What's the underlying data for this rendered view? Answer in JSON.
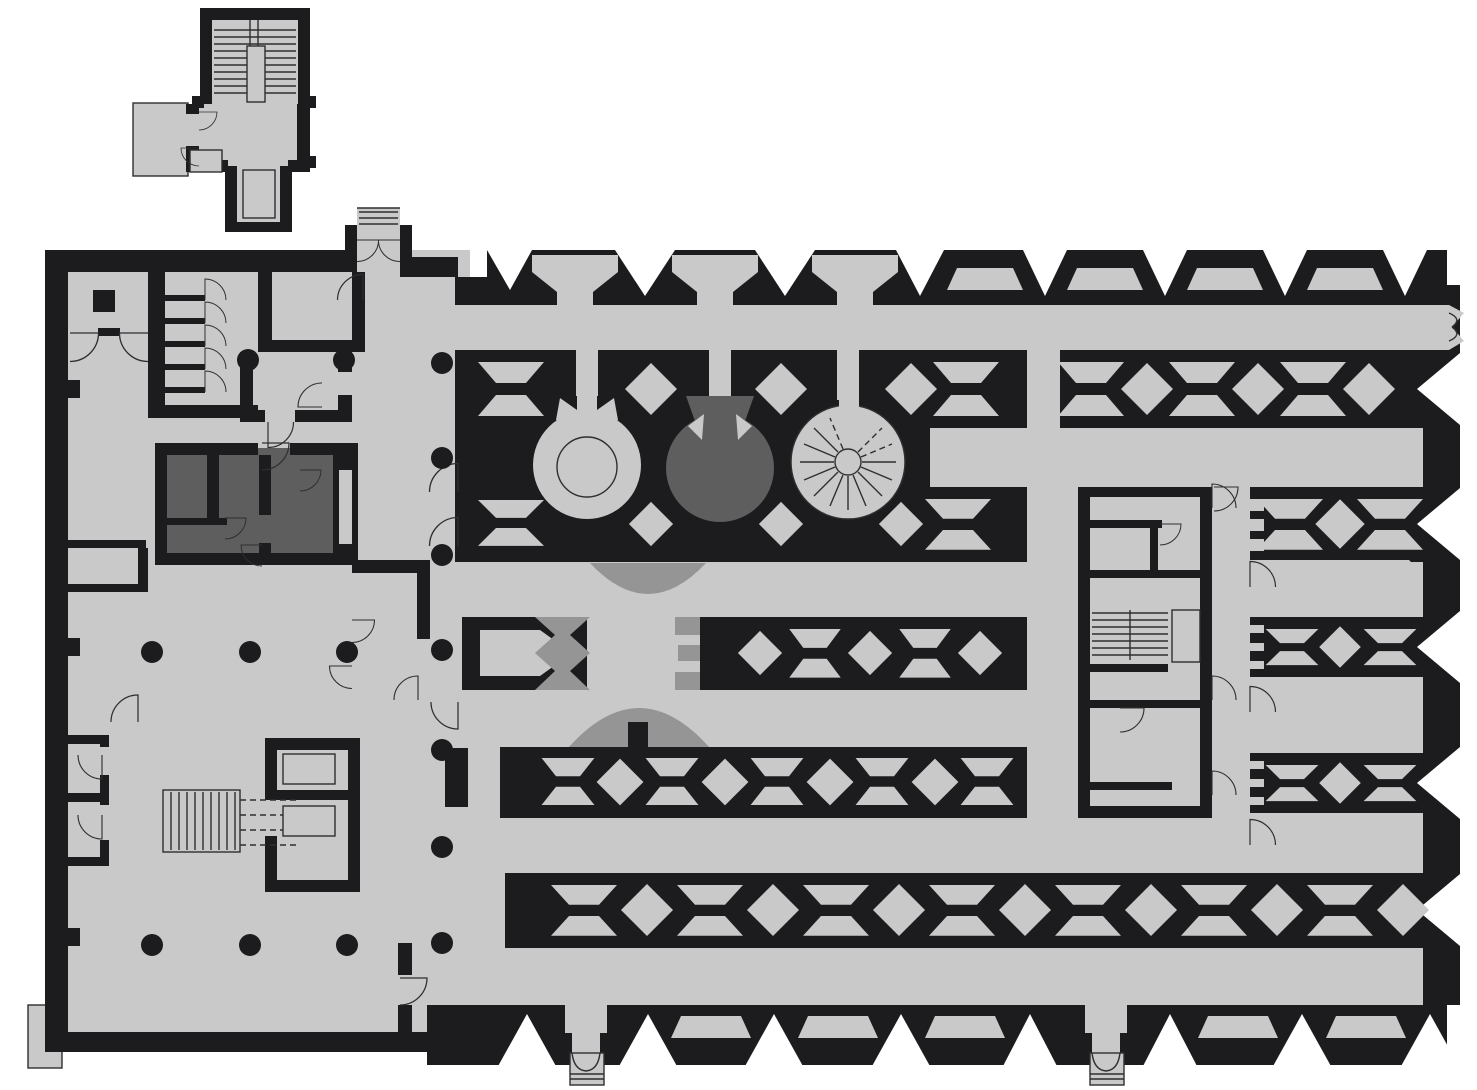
{
  "document": {
    "title": "Architectural ground-floor plan",
    "type": "floor-plan drawing",
    "visible_text": [],
    "orientation": "detached stair annex at top-left, main building below-right"
  },
  "palette": {
    "background": "#ffffff",
    "wall": "#1c1c1f",
    "floor": "#c9c9c9",
    "floor_shaded": "#959595",
    "room_dark": "#5e5e5e",
    "line": "#2f2f2f"
  },
  "features": {
    "annex": {
      "stair_flights": 2,
      "entry_doors": 2,
      "terrace": 1,
      "south_passage": 1
    },
    "left_wing": {
      "small_cells": 6,
      "dark_room_suite": 1,
      "elevator_shafts": 2,
      "stairs": 1,
      "free_columns": 15,
      "wall_niches": 4
    },
    "great_hall": {
      "rotunda_light": 1,
      "rotunda_dark": 1,
      "spiral_stair": 1,
      "semicircular_apses": 2,
      "screen_rows": 2,
      "fountain_frame": 1
    },
    "stack_wing": {
      "truss_pattern_bands": 5,
      "finger_corridors": 5,
      "stair_block": 1,
      "crenellated_edges": 3
    },
    "exits": {
      "bottom_stepped_exits": 2,
      "east_forked_exit": 1,
      "north_entry_bay": 1
    }
  }
}
